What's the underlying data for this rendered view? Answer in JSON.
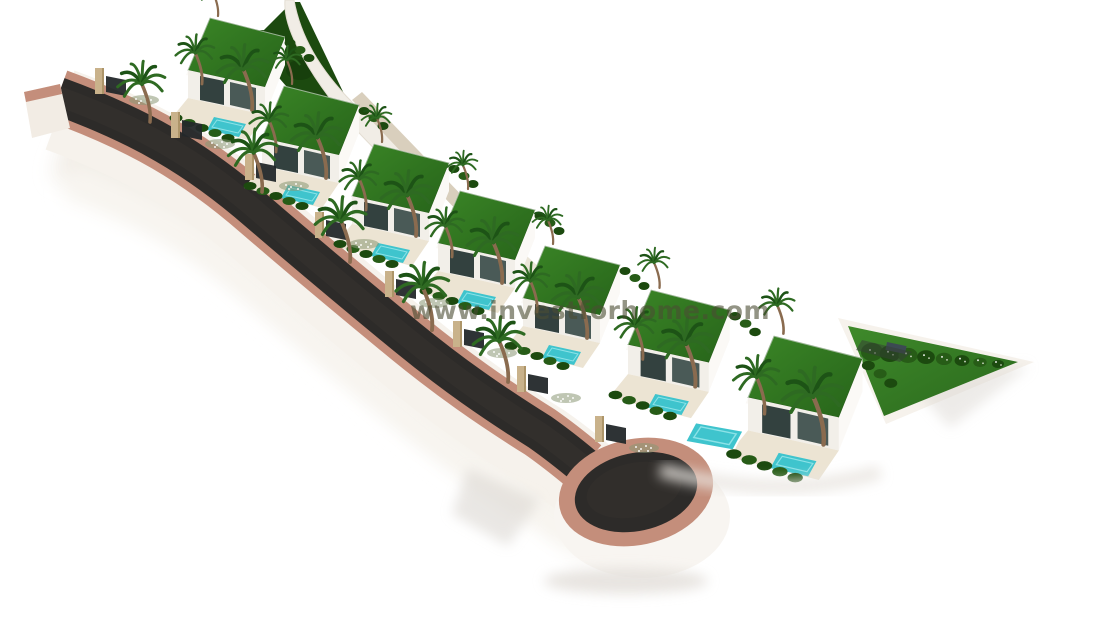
{
  "watermark": {
    "text": "www.investforhome.com",
    "color": "#4b4d33",
    "opacity": 0.6
  },
  "scene": {
    "description": "Aerial 3D architectural render of a terraced row of modern white villas with green flat roofs, private turquoise pools and palm trees, along a dark asphalt road with terracotta curbs ending in a teardrop cul-de-sac on a white background",
    "background": "#ffffff",
    "villa_count": 7,
    "colors": {
      "asphalt": "#2d2b29",
      "asphalt_light": "#37342f",
      "curb": "#c48e7b",
      "curb_dark": "#a9735f",
      "wall_white": "#fbf9f6",
      "wall_front": "#f2efe9",
      "wall_shade": "#ece8e2",
      "beige_wall": "#d9cfbd",
      "stone": "#c9b28b",
      "stone_dark": "#ad9569",
      "grass1": "#3a8526",
      "grass2": "#27641a",
      "lawn": "#3c8128",
      "hedge": "#1c4a0f",
      "hedge_light": "#275c17",
      "pool": "#3fc4cd",
      "pool_light": "#8ce2e7",
      "terrace": "#ece4d3",
      "door_dark": "#23282a",
      "glass": "#33413f",
      "glass2": "#4a5a57",
      "trunk": "#8a6b4f",
      "frond": "#2e6a22",
      "frond_dark": "#1d5316",
      "shadow": "#dcd8d3",
      "flower_bed": "#8a9774"
    },
    "villas": [
      {
        "x": 188,
        "y": 18,
        "s": 1
      },
      {
        "x": 262,
        "y": 86,
        "s": 1
      },
      {
        "x": 352,
        "y": 144,
        "s": 1
      },
      {
        "x": 438,
        "y": 191,
        "s": 1
      },
      {
        "x": 523,
        "y": 246,
        "s": 1
      },
      {
        "x": 628,
        "y": 290,
        "s": 1.05
      },
      {
        "x": 748,
        "y": 336,
        "s": 1.18,
        "big_pool": true
      }
    ],
    "gates": [
      [
        100,
        90
      ],
      [
        176,
        134
      ],
      [
        250,
        176
      ],
      [
        320,
        234
      ],
      [
        390,
        293
      ],
      [
        458,
        343
      ],
      [
        522,
        388
      ],
      [
        600,
        438
      ]
    ],
    "roadside_palms": [
      [
        150,
        122,
        1.35
      ],
      [
        262,
        192,
        1.4
      ],
      [
        350,
        262,
        1.45
      ],
      [
        432,
        330,
        1.5
      ],
      [
        508,
        382,
        1.45
      ]
    ]
  }
}
